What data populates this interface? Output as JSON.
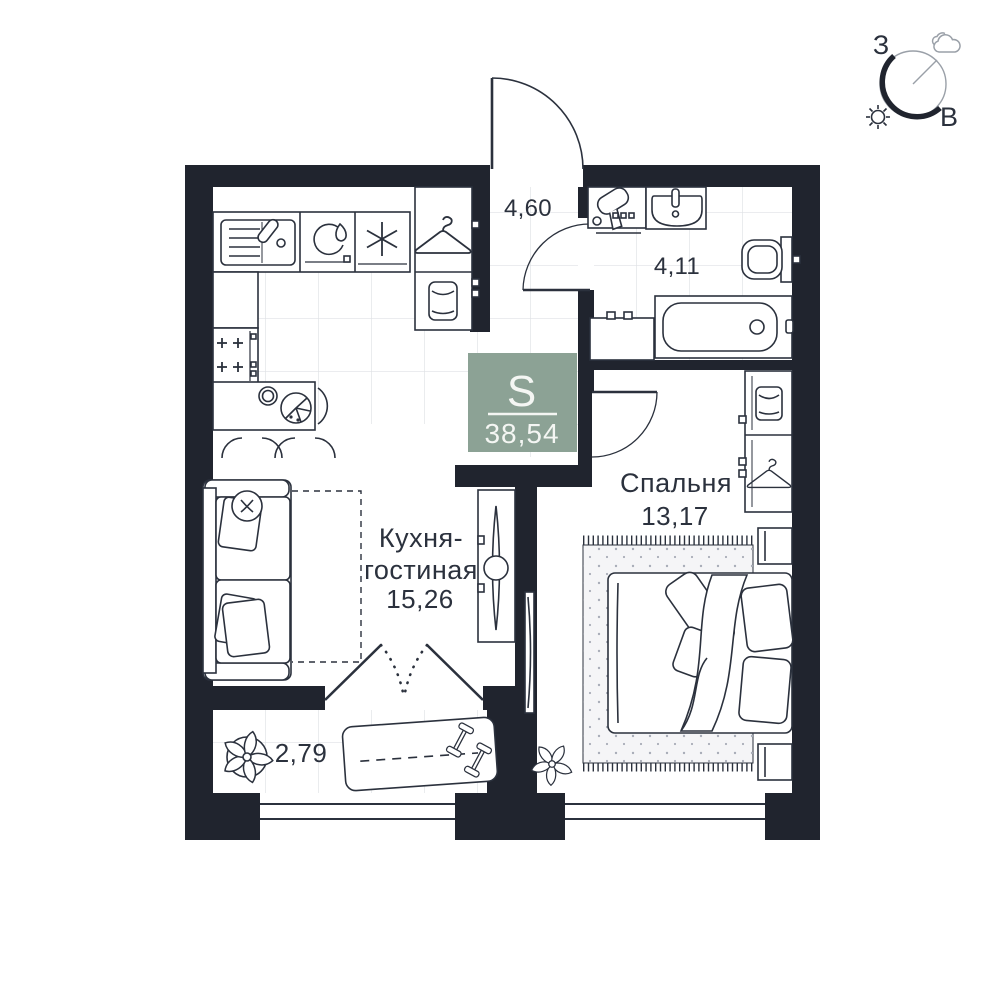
{
  "plan": {
    "type": "apartment-floor-plan",
    "language": "ru"
  },
  "total_area_badge": {
    "label": "S",
    "value": "38,54",
    "color": "#8CA295"
  },
  "rooms": {
    "kitchen_living": {
      "name_line1": "Кухня-",
      "name_line2": "гостиная",
      "area": "15,26"
    },
    "bedroom": {
      "name": "Спальня",
      "area": "13,17"
    },
    "hallway": {
      "area": "4,60"
    },
    "bathroom": {
      "area": "4,11"
    },
    "balcony": {
      "area": "2,79"
    }
  },
  "compass": {
    "west": "З",
    "east": "В"
  },
  "colors": {
    "wall": "#20242e",
    "line": "#2b313d",
    "tile_line": "#dfe1e5",
    "badge_green": "#8CA295",
    "rug_fill": "#f5f5f7"
  },
  "icons": [
    "kitchen-sink-icon",
    "dishwasher-icon",
    "fridge-snowflake-icon",
    "hob-burners-icon",
    "dining-table-icon",
    "plate-icon",
    "pie-icon",
    "chair-icon",
    "sofa-icon",
    "side-table-icon",
    "tv-console-icon",
    "coat-hanger-icon",
    "washing-machine-icon",
    "hair-dryer-icon",
    "washbasin-icon",
    "toilet-icon",
    "bathtub-icon",
    "wardrobe-icon",
    "bed-icon",
    "rug-icon",
    "nightstand-icon",
    "plant-icon",
    "exercise-mat-icon",
    "dumbbell-icon",
    "door-swing-icon",
    "window-icon",
    "compass-icon",
    "sun-icon",
    "cloud-icon"
  ]
}
